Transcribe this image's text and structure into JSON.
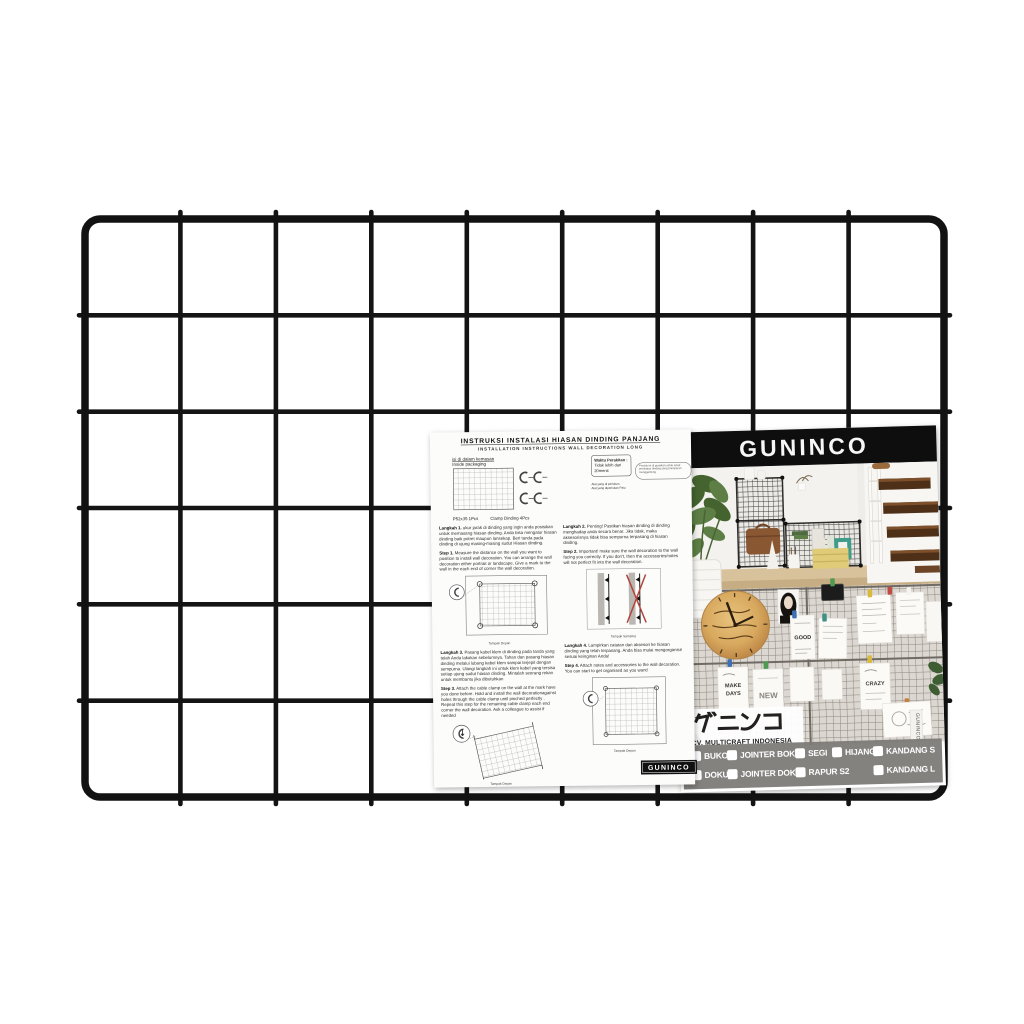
{
  "product": {
    "description": "black wire mesh wall grid panel",
    "grid_columns": 9,
    "grid_rows": 6,
    "wire_color": "#141414"
  },
  "sheet": {
    "title_id": "INSTRUKSI INSTALASI HIASAN DINDING PANJANG",
    "title_en": "INSTALLATION INSTRUCTIONS WALL DECORATION LONG",
    "package": {
      "label_id": "isi di dalam kemasan",
      "label_en": "Inside packaging",
      "panel_caption": "P52x35 1Pcs",
      "clamp_caption": "Clamp Dinding 4Pcs"
    },
    "assembly": {
      "label": "Waktu Perakitan :",
      "value": "Tidak lebih dari 20menit"
    },
    "oval_note": "Produk ini di gunakan untuk sekat pembatas dinding yang transparan menggantung",
    "tools_line1": "Alat yang di perlukan",
    "tools_line2": "Alat yang diperlukan Palu",
    "steps": [
      {
        "id_label": "Langkah 1.",
        "id_text": "ukur jarak di dinding yang ingin anda posisikan untuk memasang hiasan dinding. Anda bisa mengatur hiasan dinding baik potret maupun lansekap. Beri tanda pada dinding di ujung masing-masing sudut Hiasan dinding.",
        "en_label": "Step 1.",
        "en_text": "Measure the distance on the wall you want to position to install wall decoration. You can arrange the wall decoration either portrait or landscape. Give a mark to the wall in the each end of corner the wall decoration."
      },
      {
        "id_label": "Langkah 2.",
        "id_text": "Penting! Pastikan hiasan dinding di dinding menghadap anda secara benar. Jika tidak, maka aksesorisnya tidak bisa sempurna terpasang di hiasan dinding.",
        "en_label": "Step 2.",
        "en_text": "Important! make sure the wall decoration to the wall facing you correctly. If you don't, then the accessories/notes will not perfect fit into the wall decoration."
      },
      {
        "id_label": "Langkah 3.",
        "id_text": "Pasang kabel klem di dinding pada tanda yang telah Anda lakukan sebelumnya. Tahan dan pasang hiasan dinding melalui lubang kabel klem sampai terjepit dengan sempurna. Ulangi langkah ini untuk klem kabel yang tersisa setiap ujung sudut hiasan dinding. Mintalah seorang rekan untuk membantu jika dibutuhkan",
        "en_label": "Step 3.",
        "en_text": "Attach the cable clamp on the wall at the mark have you done before. Hold and install the wall decorationagainst holes through the cable clamp until pinched perfectly . Repeat this step for the remaining cable clamp each end corner the wall decoration. Ask a colleague to assist if needed"
      },
      {
        "id_label": "Langkah 4.",
        "id_text": "Lampirkan catatan dan aksesori ke hiasan dinding yang telah terpasang. Anda bisa mulai mengorganisir sesuai keinginan Anda!",
        "en_label": "Step 4.",
        "en_text": "Attach notes and accessories to the wall decoration. You can start to get organised as you want!"
      }
    ],
    "diagrams": {
      "d1_caption": "Tampak Depan",
      "d2_caption": "Tampak Samping",
      "d3_caption": "Tampak Depan",
      "d4_caption": "Tampak Depan"
    },
    "footer_logo": "GUNINCO"
  },
  "card": {
    "brand": "GUNINCO",
    "brand_jp": "グニンコ",
    "company": "CV. MULTICRAFT INDONESIA",
    "side_tag": "GUNINCO",
    "variants_row1": [
      "BUKO",
      "JOINTER BOKU",
      "SEGI",
      "HIJANG",
      "KANDANG S"
    ],
    "variants_row2": [
      "DOKU",
      "JOINTER DOKU",
      "RAPUR S2",
      "KANDANG L"
    ],
    "photo_texts": {
      "good": "GOOD",
      "make": "MAKE",
      "days": "DAYS",
      "new": "NEW",
      "crazy": "CRAZY"
    },
    "colors": {
      "header_bg": "#0e0e0e",
      "band_bg": "#7b7875",
      "clip_blue": "#3e6fb5",
      "clip_green": "#4f9a51",
      "clip_yellow": "#d9ba3e",
      "clip_red": "#c14a42",
      "clip_teal": "#3d9187"
    }
  }
}
